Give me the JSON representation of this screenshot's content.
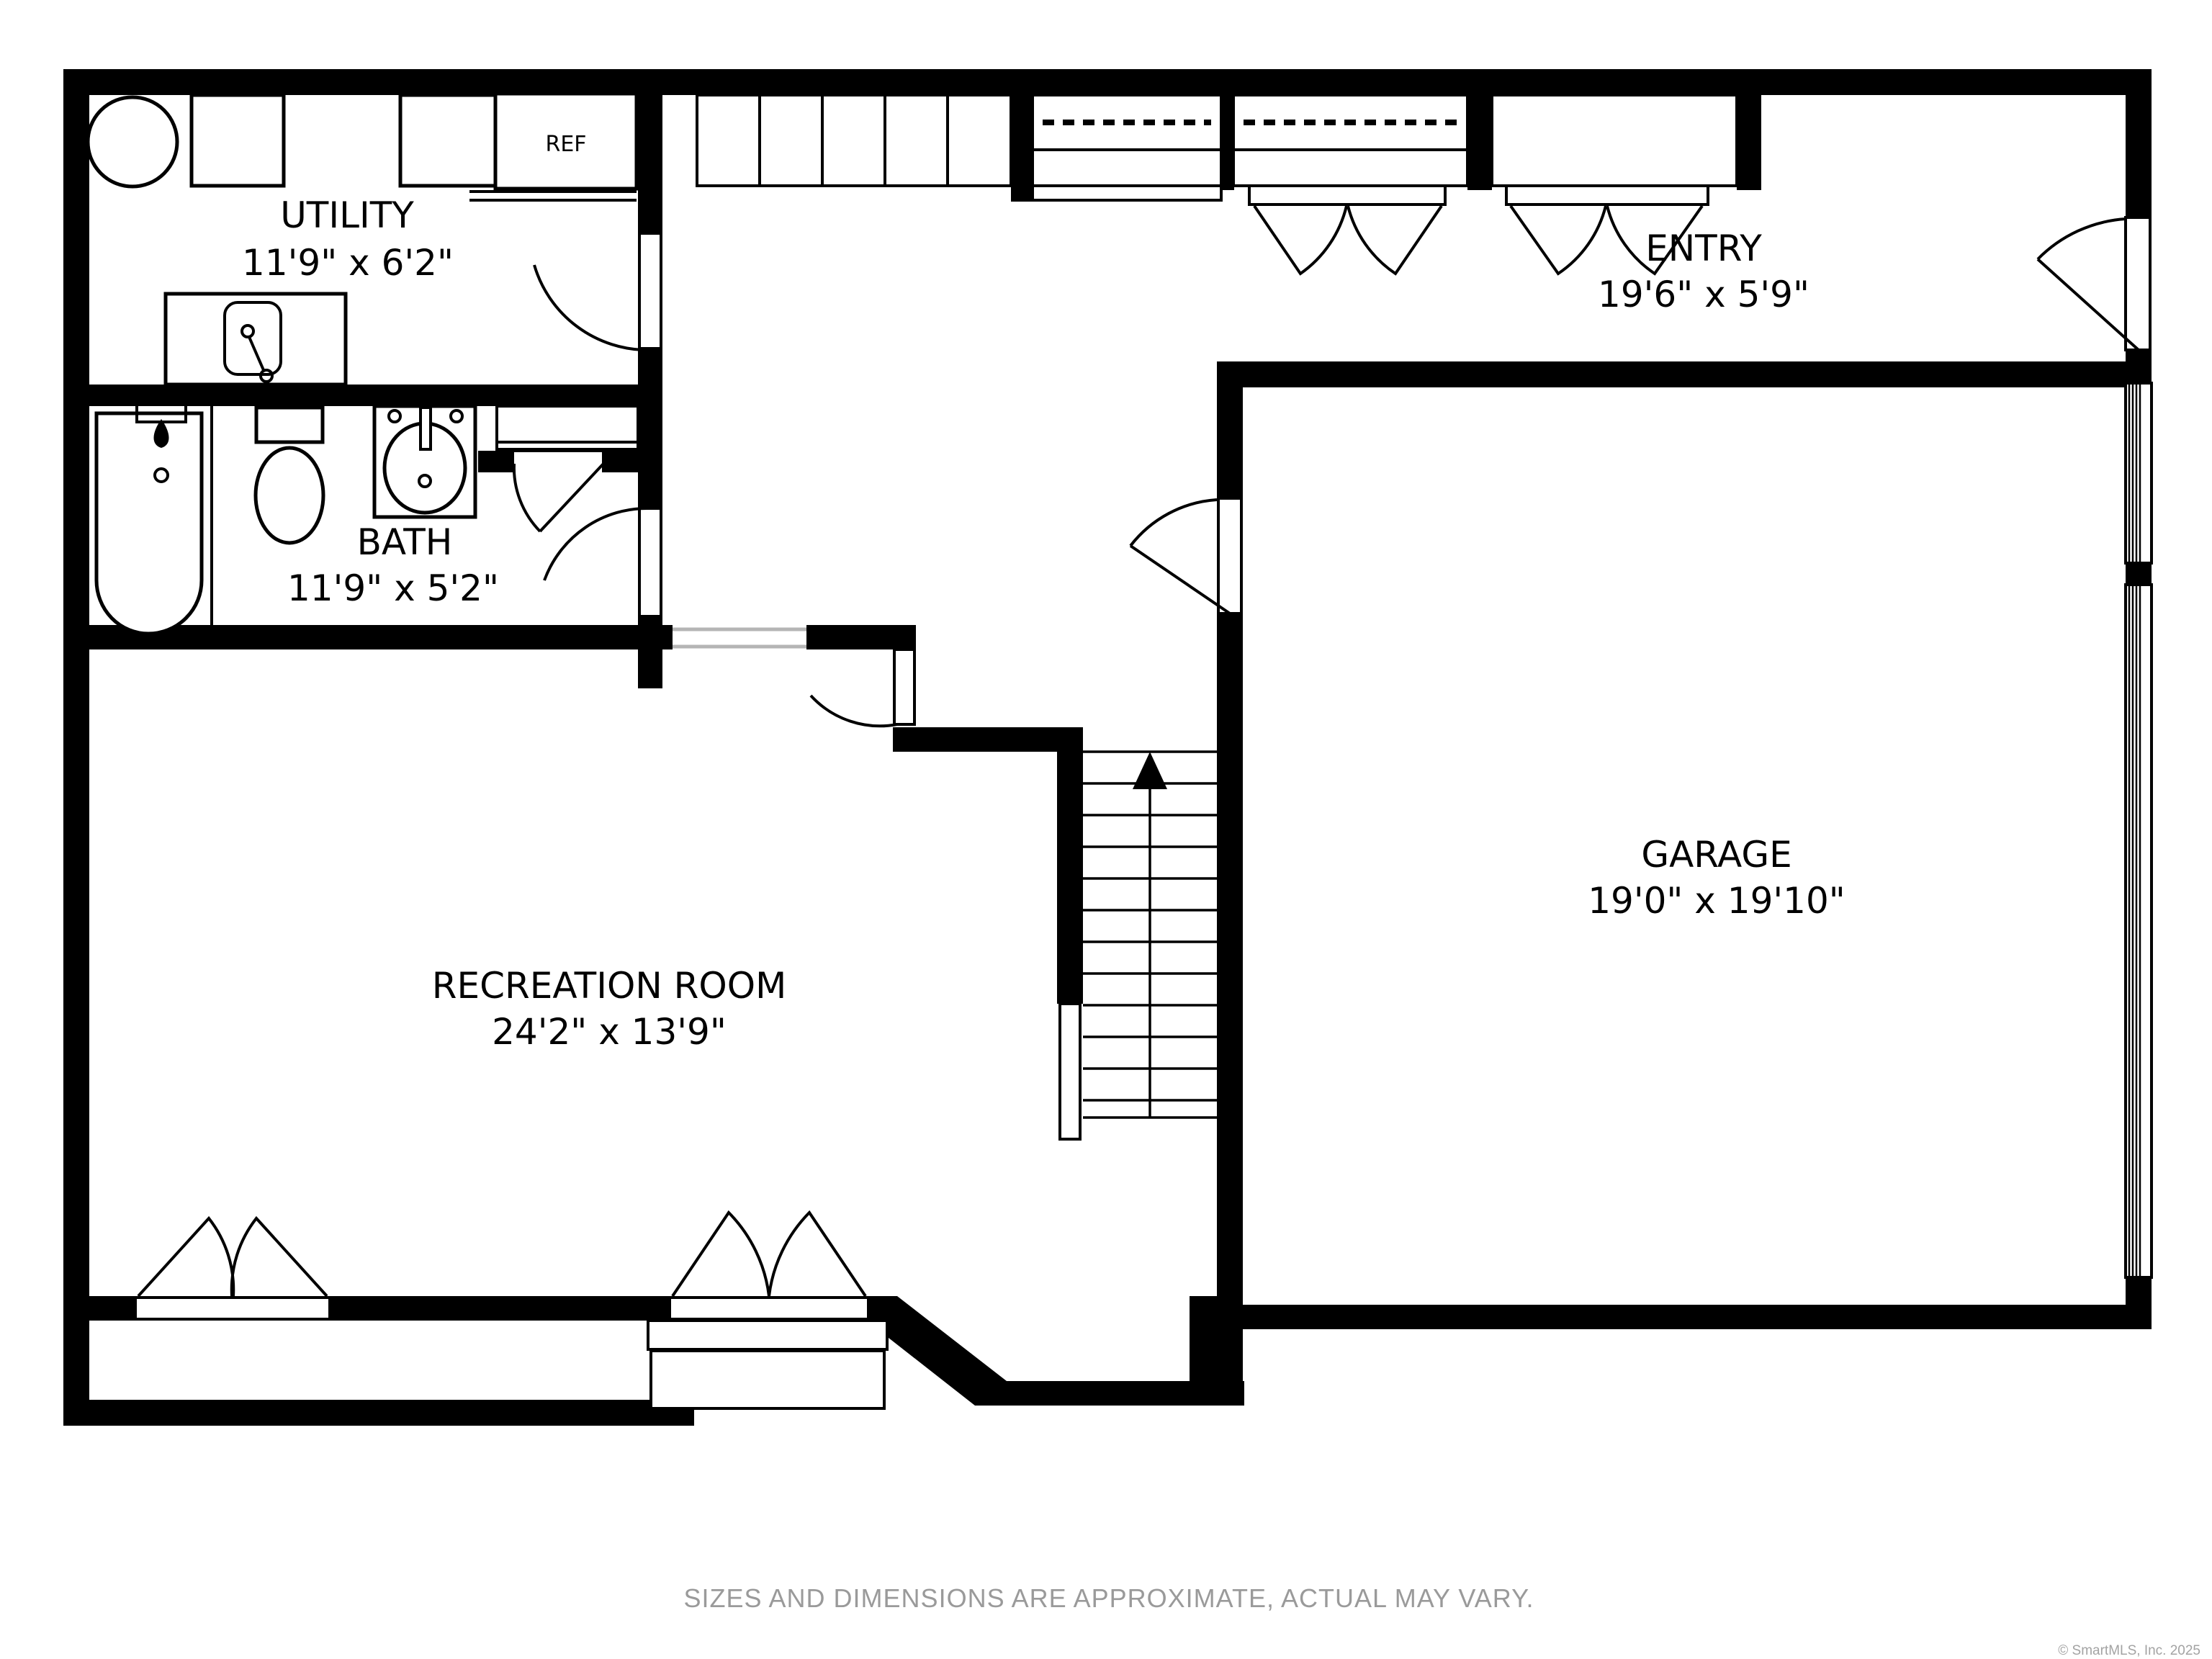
{
  "rooms": {
    "utility": {
      "name": "UTILITY",
      "dims": "11'9\" x 6'2\""
    },
    "bath": {
      "name": "BATH",
      "dims": "11'9\" x 5'2\""
    },
    "entry": {
      "name": "ENTRY",
      "dims": "19'6\" x 5'9\""
    },
    "garage": {
      "name": "GARAGE",
      "dims": "19'0\" x 19'10\""
    },
    "recreation": {
      "name": "RECREATION ROOM",
      "dims": "24'2\" x 13'9\""
    }
  },
  "labels": {
    "refrigerator": "REF"
  },
  "footer": {
    "disclaimer": "SIZES AND DIMENSIONS ARE APPROXIMATE, ACTUAL MAY VARY.",
    "copyright": "© SmartMLS, Inc.  2025"
  },
  "colors": {
    "wall": "#000000",
    "background": "#ffffff",
    "footer_text": "#9a9a9a",
    "copyright_text": "#a3a3a3",
    "opening_line": "#b5b5b5"
  }
}
